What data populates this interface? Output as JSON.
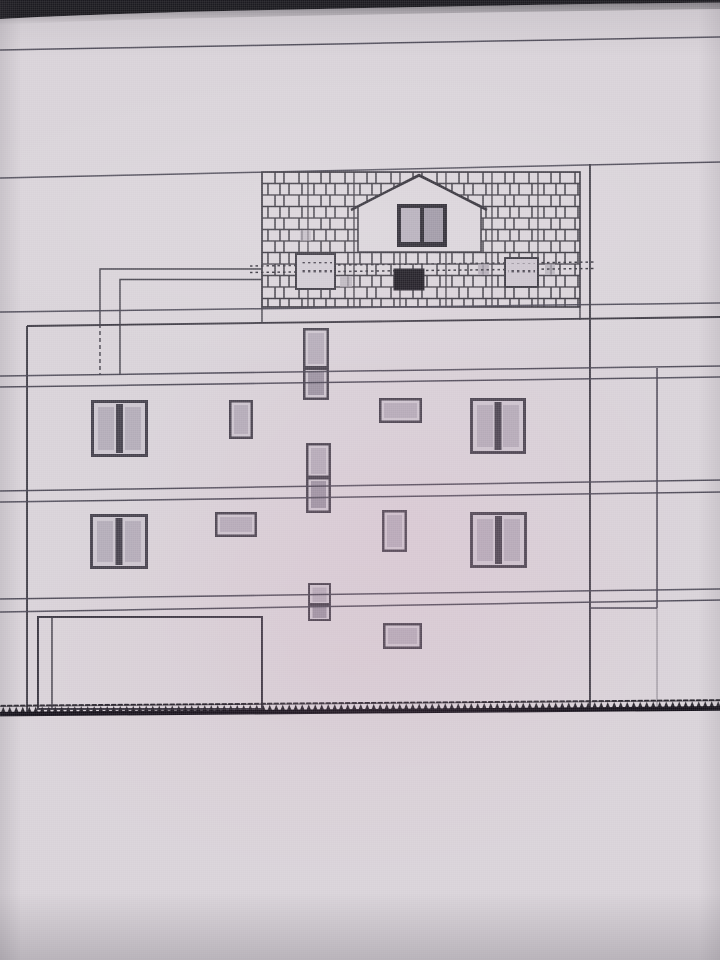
{
  "meta": {
    "description": "photo-of-screen architectural side elevation drawing, no visible text labels",
    "visible_text_items": []
  },
  "colors": {
    "paper": "#d8d2d8",
    "paper_warm": "#d6cfd5",
    "bezel": "#17161b",
    "line": "#474351",
    "line_strong": "#3e3b45",
    "hatch": "#39363f",
    "frame_dark": "#46424d",
    "frame_light": "#cbc5ce",
    "glass": "#b3acb8",
    "glass_dark": "#9a93a1",
    "dormer_frame": "#26232c",
    "vent_fill": "#cfc9d1",
    "vent_dot": "#4a4550",
    "dark_vent": "#18151d",
    "ground": "#131019"
  },
  "building": {
    "level_line_pairs": 4,
    "attic": {
      "shingle_panels": 1,
      "dormers": 1,
      "dormer_windows": 1,
      "vent_grilles": 2,
      "dark_vent_openings": 1,
      "hidden_duct_lines": 2
    },
    "upper_floor": {
      "double_casement_windows": 2,
      "small_windows": 2,
      "stair_windows": 1
    },
    "ground_floor": {
      "double_casement_windows": 2,
      "small_windows": 2,
      "stair_windows": 1
    },
    "basement_level": {
      "garage_doors": 1,
      "small_windows": 1,
      "stair_windows": 1
    },
    "side_annex_outlines": 1
  }
}
